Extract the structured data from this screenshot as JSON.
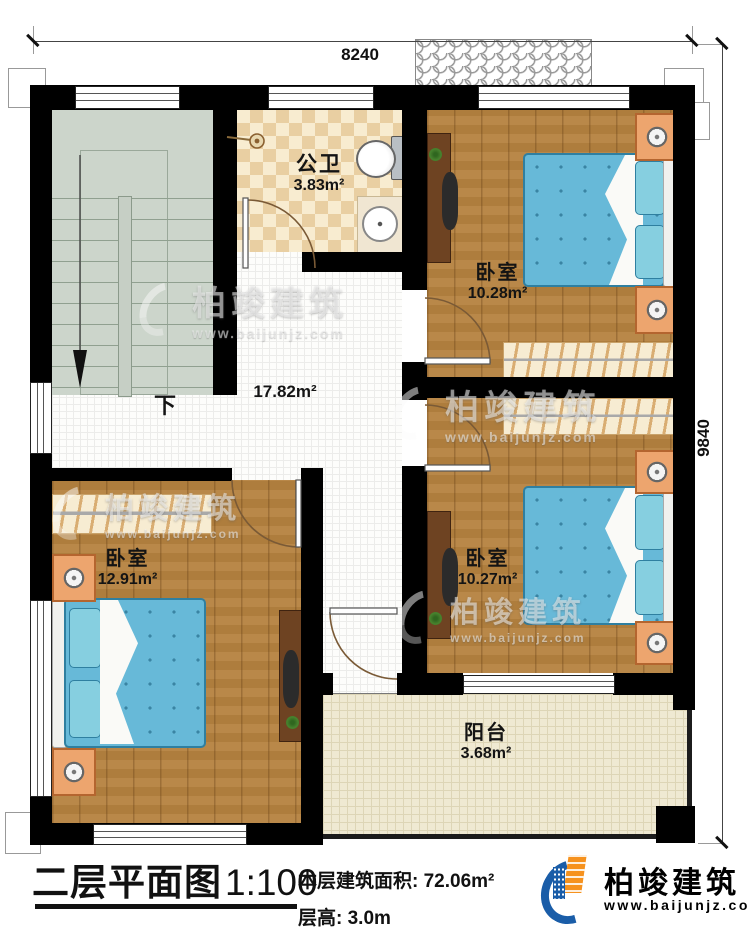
{
  "dimensions": {
    "top": "8240",
    "right": "9840"
  },
  "rooms": {
    "bathroom": {
      "name": "公卫",
      "area": "3.83m²"
    },
    "bedroom_tr": {
      "name": "卧室",
      "area": "10.28m²"
    },
    "bedroom_mr": {
      "name": "卧室",
      "area": "10.27m²"
    },
    "bedroom_left": {
      "name": "卧室",
      "area": "12.91m²"
    },
    "hall": {
      "area": "17.82m²"
    },
    "stairs": {
      "down_label": "下"
    },
    "balcony": {
      "name": "阳台",
      "area": "3.68m²"
    }
  },
  "footer": {
    "title": "二层平面图",
    "scale": "1:100",
    "area_label": "本层建筑面积:",
    "area_value": "72.06m²",
    "height_label": "层高:",
    "height_value": "3.0m"
  },
  "brand": {
    "name": "柏竣建筑",
    "website": "www.baijunjz.com"
  },
  "watermark": {
    "name": "柏竣建筑",
    "website": "www.baijunjz.com"
  },
  "colors": {
    "wall": "#000000",
    "wood_floor": "#b5823f",
    "bath_tile": "#e9cfa2",
    "stair_floor": "#ccd5cb",
    "balcony_tile": "#efe9d2",
    "mattress_blue": "#67b9d8",
    "nightstand_orange": "#eda56e",
    "brand_blue": "#1a5da8",
    "brand_orange": "#f6921e"
  }
}
